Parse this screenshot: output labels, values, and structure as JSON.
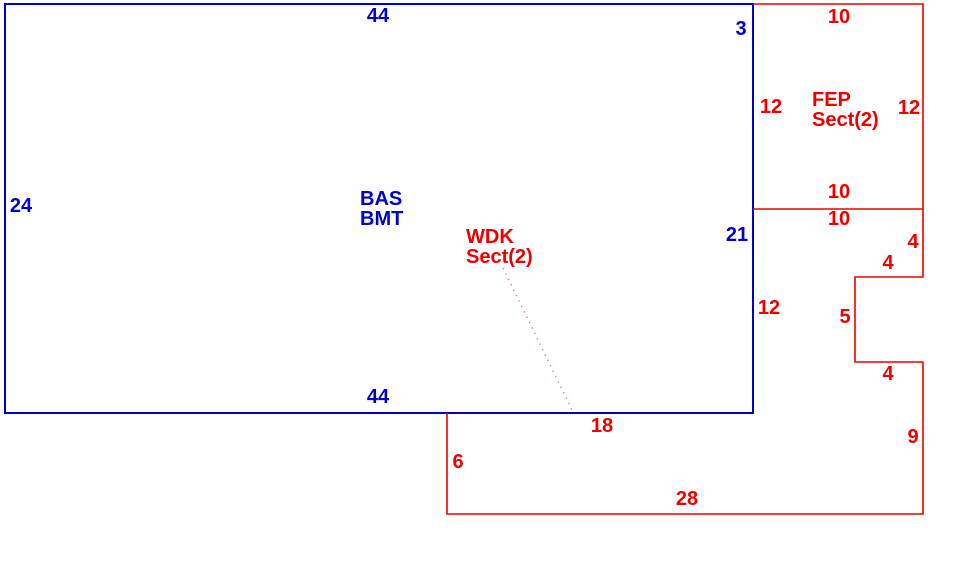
{
  "sketch": {
    "background": "#ffffff",
    "line_colors": {
      "bas_outline": "#0000cc",
      "addition_outline": "#ee0000",
      "leader_line": "#d98c8c"
    },
    "bas": {
      "name_line1": "BAS",
      "name_line2": "BMT",
      "dims": {
        "top": "44",
        "left": "24",
        "bottom": "44",
        "right_upper": "3",
        "right_lower": "21"
      }
    },
    "fep": {
      "name_line1": "FEP",
      "name_line2": "Sect(2)",
      "dims": {
        "top": "10",
        "left": "12",
        "right": "12",
        "bottom": "10"
      }
    },
    "wdk": {
      "name_line1": "WDK",
      "name_line2": "Sect(2)",
      "dims": {
        "top": "10",
        "right_upper": "4",
        "notch_top": "4",
        "notch_left": "5",
        "notch_bottom": "4",
        "right_lower": "9",
        "bottom": "28",
        "left": "6",
        "shared_bottom": "18",
        "shared_right": "12"
      }
    }
  }
}
